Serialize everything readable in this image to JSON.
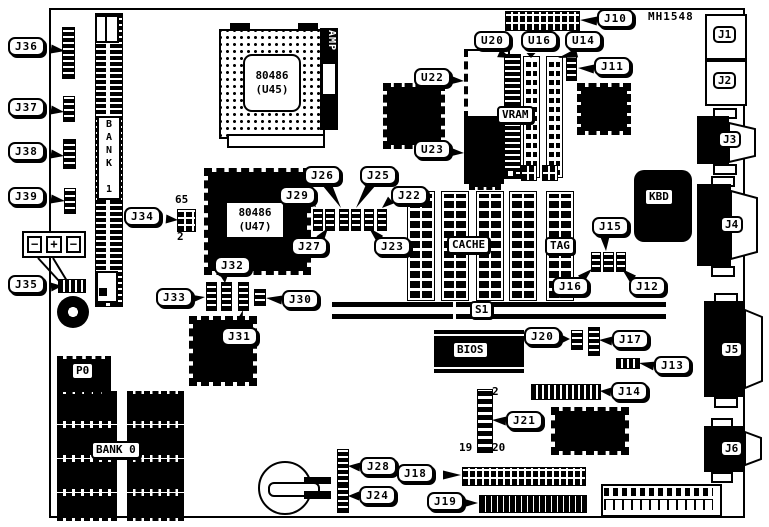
{
  "figure": {
    "part_label": "MH1548"
  },
  "chips": {
    "u45_l1": "80486",
    "u45_l2": "(U45)",
    "u47_l1": "80486",
    "u47_l2": "(U47)",
    "amp": "AMP",
    "vram": "VRAM",
    "bank1": "BANK 1",
    "bank0": "BANK 0",
    "cache": "CACHE",
    "tag": "TAG",
    "kbd": "KBD",
    "bios": "BIOS",
    "s1": "S1",
    "p0": "P0"
  },
  "ports": [
    "J1",
    "J2",
    "J3",
    "J4",
    "J5",
    "J6"
  ],
  "battery": {
    "terminals": [
      "−",
      "+",
      "−"
    ]
  },
  "annotations": {
    "j34_top": "65",
    "j34_bottom": "2",
    "j21_top": "2",
    "j21_bottom_left": "19",
    "j21_bottom_right": "20"
  },
  "callouts": [
    {
      "label": "J36",
      "x": 8,
      "y": 37,
      "fx": 51,
      "fy": 49,
      "tx": 65,
      "ty": 51
    },
    {
      "label": "J37",
      "x": 8,
      "y": 98,
      "fx": 51,
      "fy": 110,
      "tx": 64,
      "ty": 112
    },
    {
      "label": "J38",
      "x": 8,
      "y": 142,
      "fx": 51,
      "fy": 154,
      "tx": 64,
      "ty": 156
    },
    {
      "label": "J39",
      "x": 8,
      "y": 187,
      "fx": 51,
      "fy": 199,
      "tx": 65,
      "ty": 201
    },
    {
      "label": "J35",
      "x": 8,
      "y": 275,
      "fx": 51,
      "fy": 287,
      "tx": 62,
      "ty": 286
    },
    {
      "label": "J34",
      "x": 124,
      "y": 207,
      "fx": 166,
      "fy": 219,
      "tx": 178,
      "ty": 220
    },
    {
      "label": "J10",
      "x": 597,
      "y": 9,
      "fx": 597,
      "fy": 21,
      "tx": 580,
      "ty": 20
    },
    {
      "label": "J11",
      "x": 594,
      "y": 57,
      "fx": 594,
      "fy": 69,
      "tx": 578,
      "ty": 68
    },
    {
      "label": "U20",
      "x": 474,
      "y": 31,
      "fx": 499,
      "fy": 53,
      "tx": 510,
      "ty": 58
    },
    {
      "label": "U16",
      "x": 521,
      "y": 31,
      "fx": 531,
      "fy": 53,
      "tx": 531,
      "ty": 58
    },
    {
      "label": "U14",
      "x": 565,
      "y": 31,
      "fx": 577,
      "fy": 53,
      "tx": 558,
      "ty": 58
    },
    {
      "label": "U22",
      "x": 414,
      "y": 68,
      "fx": 450,
      "fy": 80,
      "tx": 464,
      "ty": 81
    },
    {
      "label": "U23",
      "x": 414,
      "y": 140,
      "fx": 450,
      "fy": 152,
      "tx": 464,
      "ty": 153
    },
    {
      "label": "J29",
      "x": 279,
      "y": 186,
      "fx": 310,
      "fy": 200,
      "tx": 316,
      "ty": 207
    },
    {
      "label": "J26",
      "x": 304,
      "y": 166,
      "fx": 327,
      "fy": 184,
      "tx": 341,
      "ty": 208
    },
    {
      "label": "J25",
      "x": 360,
      "y": 166,
      "fx": 371,
      "fy": 184,
      "tx": 356,
      "ty": 208
    },
    {
      "label": "J22",
      "x": 391,
      "y": 186,
      "fx": 391,
      "fy": 200,
      "tx": 382,
      "ty": 208
    },
    {
      "label": "J27",
      "x": 291,
      "y": 237,
      "fx": 320,
      "fy": 239,
      "tx": 328,
      "ty": 228
    },
    {
      "label": "J23",
      "x": 374,
      "y": 237,
      "fx": 380,
      "fy": 239,
      "tx": 369,
      "ty": 228
    },
    {
      "label": "J32",
      "x": 214,
      "y": 256,
      "fx": 224,
      "fy": 274,
      "tx": 225,
      "ty": 283
    },
    {
      "label": "J33",
      "x": 156,
      "y": 288,
      "fx": 190,
      "fy": 299,
      "tx": 205,
      "ty": 297
    },
    {
      "label": "J30",
      "x": 282,
      "y": 290,
      "fx": 282,
      "fy": 300,
      "tx": 266,
      "ty": 298
    },
    {
      "label": "J31",
      "x": 221,
      "y": 327,
      "fx": 238,
      "fy": 327,
      "tx": 243,
      "ty": 310
    },
    {
      "label": "J15",
      "x": 592,
      "y": 217,
      "fx": 605,
      "fy": 237,
      "tx": 606,
      "ty": 251
    },
    {
      "label": "J16",
      "x": 552,
      "y": 277,
      "fx": 581,
      "fy": 279,
      "tx": 592,
      "ty": 269
    },
    {
      "label": "J12",
      "x": 629,
      "y": 277,
      "fx": 633,
      "fy": 279,
      "tx": 622,
      "ty": 269
    },
    {
      "label": "J20",
      "x": 524,
      "y": 327,
      "fx": 561,
      "fy": 339,
      "tx": 570,
      "ty": 339
    },
    {
      "label": "J17",
      "x": 612,
      "y": 330,
      "fx": 612,
      "fy": 341,
      "tx": 599,
      "ty": 340
    },
    {
      "label": "J13",
      "x": 654,
      "y": 356,
      "fx": 654,
      "fy": 366,
      "tx": 639,
      "ty": 363
    },
    {
      "label": "J14",
      "x": 611,
      "y": 382,
      "fx": 611,
      "fy": 392,
      "tx": 600,
      "ty": 391
    },
    {
      "label": "J21",
      "x": 506,
      "y": 411,
      "fx": 506,
      "fy": 421,
      "tx": 492,
      "ty": 420
    },
    {
      "label": "J18",
      "x": 397,
      "y": 464,
      "fx": 443,
      "fy": 475,
      "tx": 461,
      "ty": 475
    },
    {
      "label": "J19",
      "x": 427,
      "y": 492,
      "fx": 463,
      "fy": 503,
      "tx": 478,
      "ty": 503
    },
    {
      "label": "J28",
      "x": 360,
      "y": 457,
      "fx": 360,
      "fy": 467,
      "tx": 348,
      "ty": 466
    },
    {
      "label": "J24",
      "x": 359,
      "y": 486,
      "fx": 359,
      "fy": 496,
      "tx": 348,
      "ty": 496
    }
  ]
}
